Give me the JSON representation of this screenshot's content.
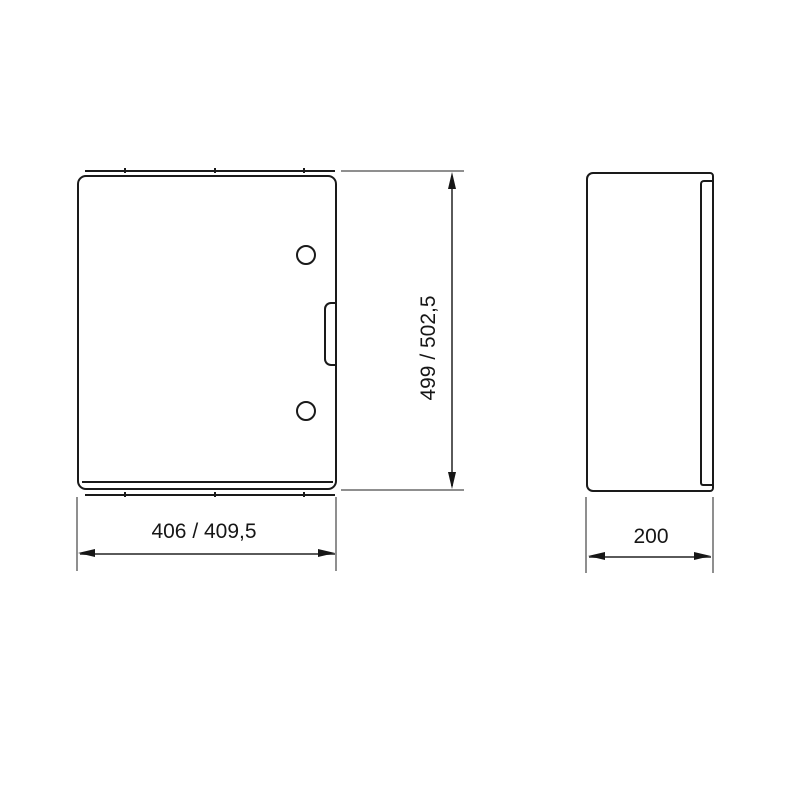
{
  "drawing": {
    "type": "technical-dimension-drawing",
    "subject": "wall-mounted enclosure cabinet shown in front view and side view",
    "views": {
      "front": {
        "name": "front-view",
        "features": [
          "door panel",
          "upper lock hole",
          "lower lock hole",
          "door handle recess",
          "top body edge",
          "bottom body edge",
          "bottom door seam"
        ]
      },
      "side": {
        "name": "side-view",
        "features": [
          "cabinet body outline",
          "door panel edge strip"
        ]
      }
    },
    "dimensions": {
      "height": {
        "label": "499 / 502,5",
        "orientation": "vertical"
      },
      "width": {
        "label": "406 / 409,5",
        "orientation": "horizontal"
      },
      "depth": {
        "label": "200",
        "orientation": "horizontal"
      }
    },
    "colors": {
      "object_line": "#1a1a1a",
      "dimension_line": "#5a5a5a",
      "extension_line": "#8f8f8f",
      "text": "#161616",
      "background": "#ffffff"
    }
  }
}
